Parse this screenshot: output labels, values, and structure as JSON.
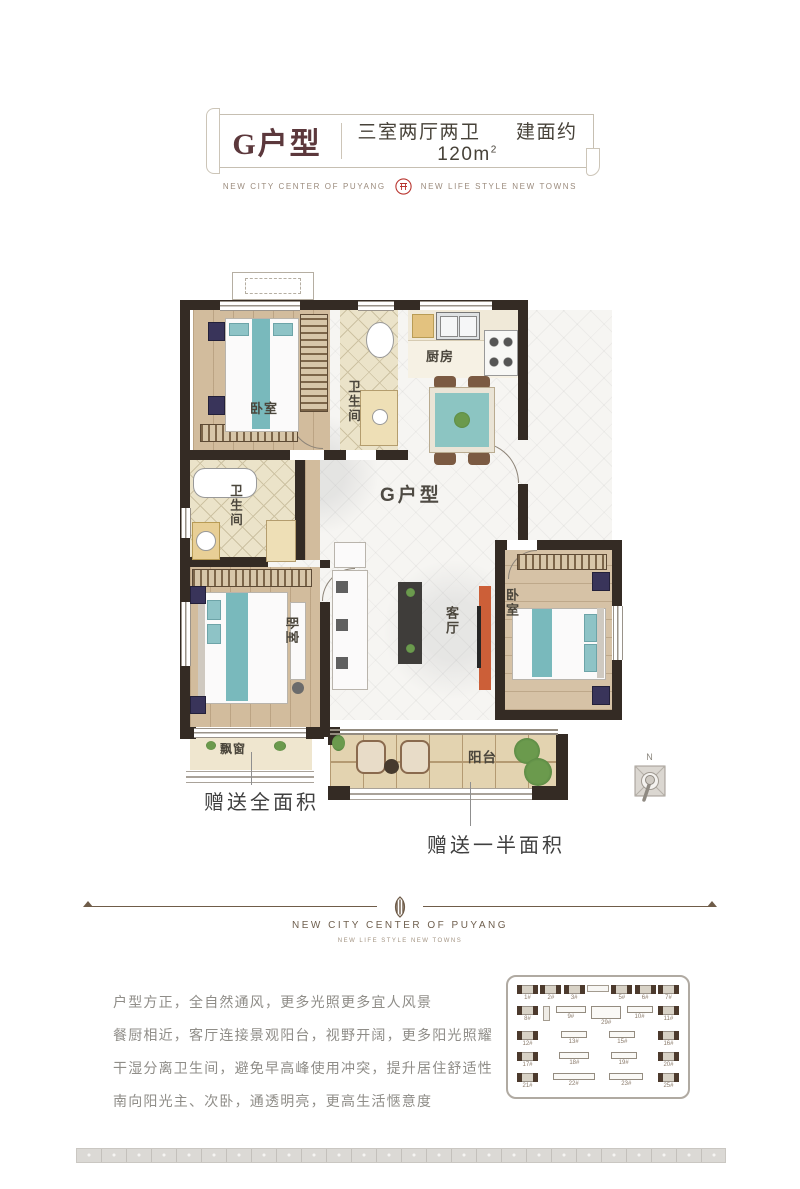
{
  "header": {
    "unit_name": "G户型",
    "layout_spec": "三室两厅两卫",
    "area_label": "建面约120m",
    "area_sup": "2"
  },
  "brand": {
    "left_text": "NEW CITY CENTER OF PUYANG",
    "right_text": "NEW LIFE STYLE NEW TOWNS"
  },
  "floorplan": {
    "unit_label": "G户型",
    "rooms": {
      "bedroom_top": "卧室",
      "bath_top": "卫生间",
      "kitchen": "厨房",
      "bath_left": "卫生间",
      "bedroom_master": "卧室",
      "living_room": "客厅",
      "bedroom_right": "卧室",
      "bay_window": "飘窗",
      "balcony": "阳台"
    },
    "annotations": {
      "gift_full_area": "赠送全面积",
      "gift_half_area": "赠送一半面积"
    },
    "compass": "N"
  },
  "divider": {
    "title": "NEW CITY CENTER OF PUYANG",
    "subtitle": "NEW LIFE STYLE NEW TOWNS"
  },
  "description": {
    "lines": [
      "户型方正，全自然通风，更多光照更多宜人风景",
      "餐厨相近，客厅连接景观阳台，视野开阔，更多阳光照耀",
      "干湿分离卫生间，避免早高峰使用冲突，提升居住舒适性",
      "南向阳光主、次卧，通透明亮，更高生活惬意度"
    ]
  },
  "siteplan": {
    "rows": [
      [
        "1#",
        "2#",
        "3#",
        "5#",
        "6#",
        "7#"
      ],
      [
        "8#",
        "9#",
        "29#",
        "10#",
        "11#"
      ],
      [
        "12#",
        "13#",
        "15#",
        "16#"
      ],
      [
        "17#",
        "18#",
        "19#",
        "20#"
      ],
      [
        "21#",
        "22#",
        "23#",
        "25#"
      ]
    ]
  },
  "colors": {
    "accent_maroon": "#5c383c",
    "seal_red": "#b8342e",
    "wall": "#342b24",
    "teal": "#79b9bc",
    "tv_stand_orange": "#cc5f38"
  }
}
